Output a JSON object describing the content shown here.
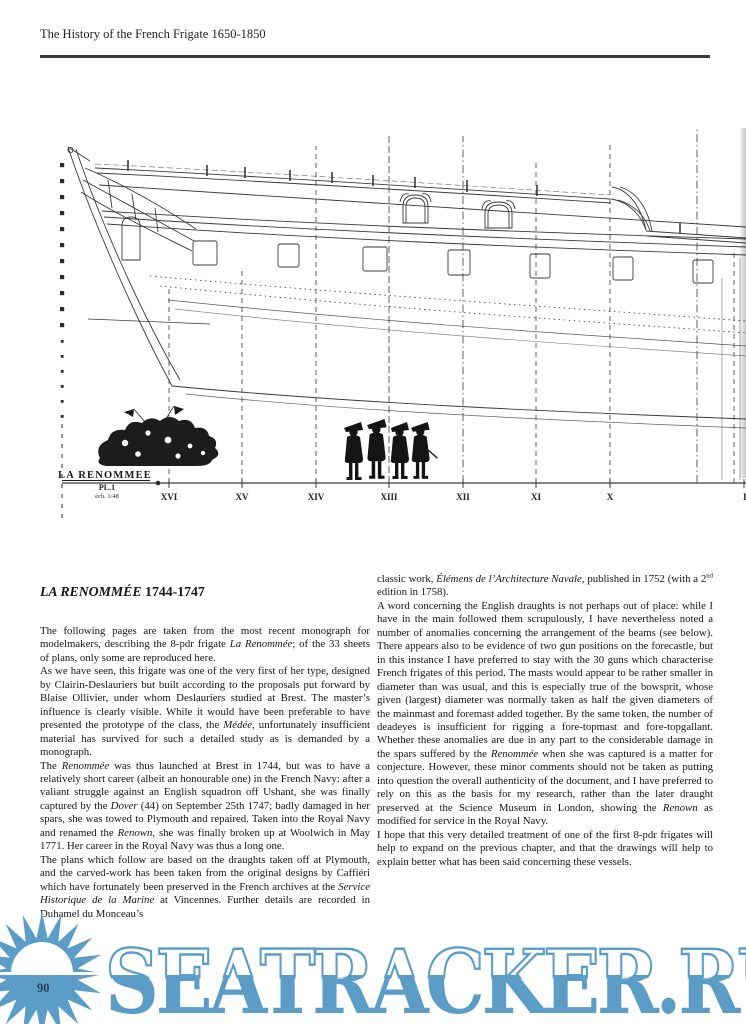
{
  "page": {
    "header": "The History of the French Frigate 1650-1850",
    "page_number": "90"
  },
  "drawing": {
    "title": "LA RENOMMEE",
    "plate": "PL.1",
    "scale_note": "éch. 1/48",
    "stations": [
      {
        "label": "XVI"
      },
      {
        "label": "XV"
      },
      {
        "label": "XIV"
      },
      {
        "label": "XIII"
      },
      {
        "label": "XII"
      },
      {
        "label": "XI"
      },
      {
        "label": "X"
      },
      {
        "label": "IX"
      }
    ]
  },
  "article": {
    "heading": {
      "name": "LA RENOMMÉE",
      "dates": "1744-1747"
    },
    "left_paragraphs": [
      [
        [
          "The following pages are taken from the most recent monograph for modelmakers, describing the 8-pdr frigate ",
          ""
        ],
        [
          "La Renommée",
          "i"
        ],
        [
          "; of the 33 sheets of plans, only some are reproduced here.",
          ""
        ]
      ],
      [
        [
          "As we have seen, this frigate was one of the very first of her type, designed by Clairin-Deslauriers but built according to the proposals put forward by Blaise Ollivier, under whom Deslauriers studied at Brest. The master’s influence is clearly visible. While it would have been preferable to have presented the prototype of the class, the ",
          ""
        ],
        [
          "Médée",
          "i"
        ],
        [
          ", unfortunately insufficient material has survived for such a detailed study as is demanded by a monograph.",
          ""
        ]
      ],
      [
        [
          "The ",
          ""
        ],
        [
          "Renommée",
          "i"
        ],
        [
          " was thus launched at Brest in 1744, but was to have a relatively short career (albeit an honourable one) in the French Navy: after a valiant struggle against an English squadron off Ushant, she was finally captured by the ",
          ""
        ],
        [
          "Dover",
          "i"
        ],
        [
          " (44) on September 25th 1747; badly damaged in her spars, she was towed to Plymouth and repaired. Taken into the Royal Navy and renamed the ",
          ""
        ],
        [
          "Renown",
          "i"
        ],
        [
          ", she was finally broken up at Woolwich in May 1771. Her career in the Royal Navy was thus a long one.",
          ""
        ]
      ],
      [
        [
          "The plans which follow are based on the draughts taken off at Plymouth, and the carved-work has been taken from the original designs by Caffiéri which have fortunately been preserved in the French archives at the ",
          ""
        ],
        [
          "Service Historique de la Marine",
          "i"
        ],
        [
          " at Vincennes. Further details are recorded in Duhamel du Monceau’s",
          ""
        ]
      ]
    ],
    "right_paragraphs": [
      [
        [
          "classic work, ",
          ""
        ],
        [
          "Élémens de l’Architecture Navale",
          "i"
        ],
        [
          ", published in 1752 (with a 2",
          ""
        ],
        [
          "nd",
          "sup"
        ],
        [
          " edition in 1758).",
          ""
        ]
      ],
      [
        [
          "A word concerning the English draughts is not perhaps out of place: while I have in the main followed them scrupulously, I have nevertheless noted a number of anomalies concerning the arrangement of the beams (see below). There appears also to be evidence of two gun positions on the forecastle, but in this instance I have preferred to stay with the 30 guns which characterise French frigates of this period. The masts would appear to be rather smaller in diameter than was usual, and this is especially true of the bowsprit, whose given (largest) diameter was normally taken as half the given diameters of the mainmast and foremast added together. By the same token, the number of deadeyes is insufficient for rigging a fore-topmast and fore-topgallant. Whether these anomalies are due in any part to the considerable damage in the spars suffered by the ",
          ""
        ],
        [
          "Renommée",
          "i"
        ],
        [
          " when she was captured is a matter for conjecture. However, these minor comments should not be taken as putting into question the overall authenticity of the document, and I have preferred to rely on this as the basis for my research, rather than the later draught preserved at the Science Museum in London, showing the ",
          ""
        ],
        [
          "Renown",
          "i"
        ],
        [
          " as modified for service in the Royal Navy.",
          ""
        ]
      ],
      [
        [
          "I hope that this very detailed treatment of one of the first 8-pdr frigates will help to expand on the previous chapter, and that the drawings will help to explain better what has been said concerning these vessels.",
          ""
        ]
      ]
    ]
  },
  "watermark": {
    "text": "SEATRACKER.RU",
    "color": "#5b9dc7"
  }
}
